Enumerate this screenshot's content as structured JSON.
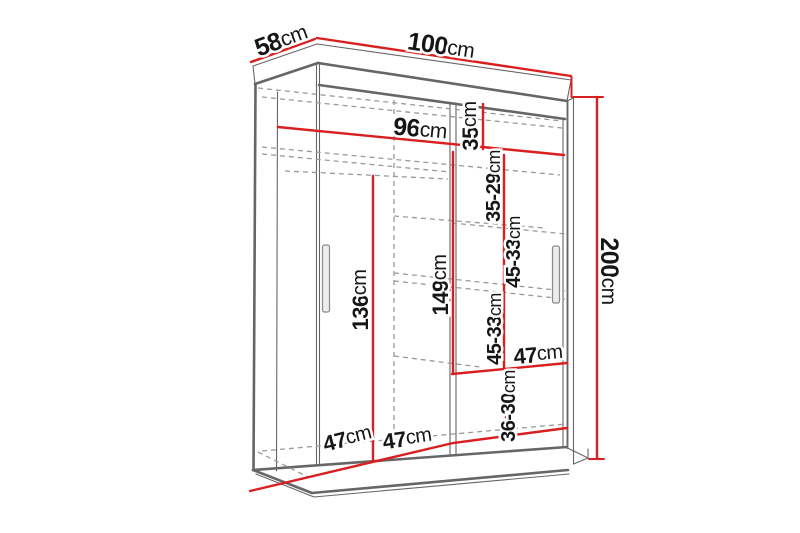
{
  "diagram": {
    "subject": "wardrobe-dimension-diagram",
    "dimensions": {
      "depth": {
        "value": "58",
        "unit": "cm"
      },
      "width": {
        "value": "100",
        "unit": "cm"
      },
      "height": {
        "value": "200",
        "unit": "cm"
      },
      "interior_width": {
        "value": "96",
        "unit": "cm"
      },
      "top_shelf_height": {
        "value": "35",
        "unit": "cm"
      },
      "shelf_gap_1": {
        "value": "35-29",
        "unit": "cm"
      },
      "shelf_gap_2": {
        "value": "45-33",
        "unit": "cm"
      },
      "shelf_gap_3": {
        "value": "45-33",
        "unit": "cm"
      },
      "shelf_gap_4": {
        "value": "36-30",
        "unit": "cm"
      },
      "right_section_height": {
        "value": "149",
        "unit": "cm"
      },
      "left_section_height": {
        "value": "136",
        "unit": "cm"
      },
      "shelf_width": {
        "value": "47",
        "unit": "cm"
      },
      "bottom_left_width": {
        "value": "47",
        "unit": "cm"
      },
      "bottom_right_width": {
        "value": "47",
        "unit": "cm"
      }
    },
    "colors": {
      "dimension": "#d91f1f",
      "outline": "#666666",
      "dashed": "#9a9a9a",
      "label": "#161616",
      "background": "#ffffff"
    }
  }
}
